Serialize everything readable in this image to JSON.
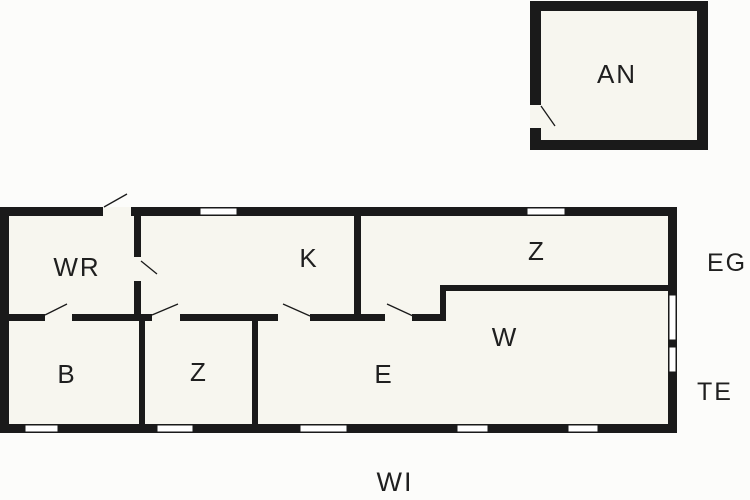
{
  "diagram_type": "floor-plan",
  "colors": {
    "wall": "#1a1a1a",
    "room-fill": "#f7f6ef",
    "background": "#fcfcfa",
    "label": "#1f1f1f"
  },
  "rooms": {
    "an": {
      "label": "AN"
    },
    "wr": {
      "label": "WR"
    },
    "k": {
      "label": "K"
    },
    "z_top": {
      "label": "Z"
    },
    "b": {
      "label": "B"
    },
    "z_bottom": {
      "label": "Z"
    },
    "e": {
      "label": "E"
    },
    "w": {
      "label": "W"
    }
  },
  "outside_labels": {
    "eg": {
      "label": "EG"
    },
    "te": {
      "label": "TE"
    },
    "wi": {
      "label": "WI"
    }
  }
}
